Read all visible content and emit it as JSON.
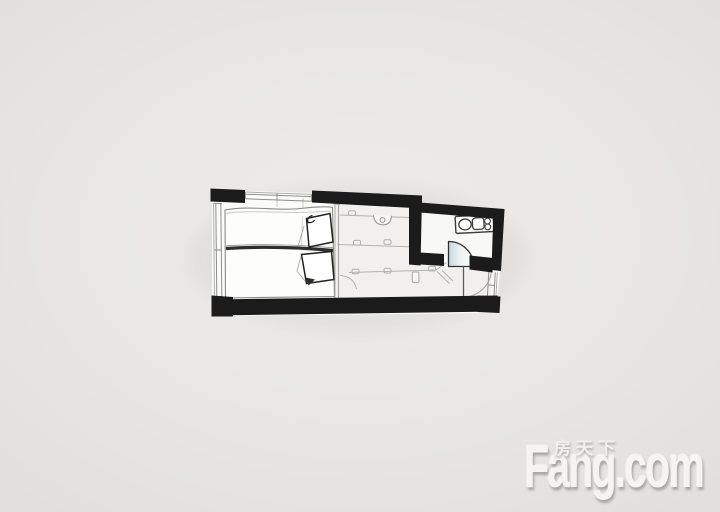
{
  "watermark": {
    "logo_text": "Fang.com",
    "chinese_label": "房天下"
  },
  "colors": {
    "page_background": "#e7e6e4",
    "walls": "#1b1b1b",
    "floor": "#fbfbf9",
    "furniture_line": "#b4b4ae",
    "bathroom_door_leaf": "#cfdde6",
    "watermark_text": "#f5f3f1"
  },
  "floorplan_elements": [
    "double-bed-with-pillows",
    "bed-divider-roll",
    "kitchen-counter-lines",
    "washbasin",
    "bathroom-vanity-with-sink",
    "bathroom-door-swing",
    "entry-door-swing",
    "left-window",
    "top-window",
    "right-window",
    "black-load-bearing-walls"
  ]
}
